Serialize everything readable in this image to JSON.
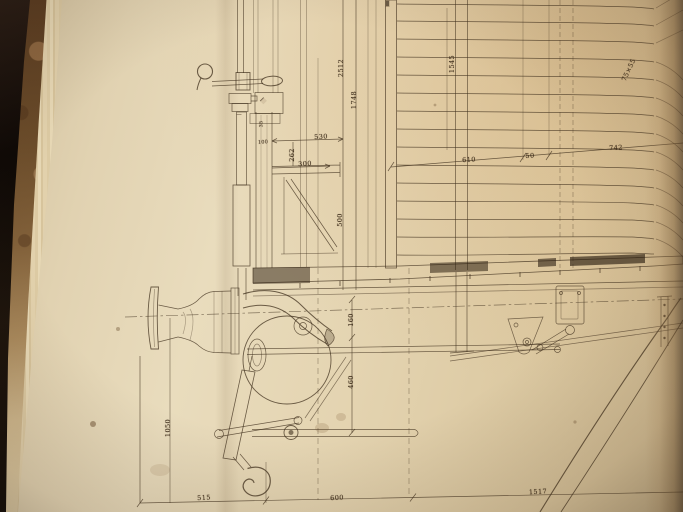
{
  "photo": {
    "subject": "engineering-drawing-in-bound-book",
    "colors": {
      "paper_light": "#e9dcbd",
      "paper_dark": "#d3bd93",
      "ink": "#40301e",
      "book_cover": "#0d0805",
      "marbled_edge": "#6b4c2a",
      "page_curl_shadow": "#4a3721"
    }
  },
  "drawing": {
    "dimensions": {
      "d2512": "2512",
      "d1748": "1748",
      "d530": "530",
      "d262": "262",
      "d300": "300",
      "d1545": "1545",
      "d75x55": "75×55",
      "d610": "610",
      "d50": "50",
      "d742": "742",
      "d500": "500",
      "d160": "160",
      "d460": "460",
      "d1050": "1050",
      "d515": "515",
      "d600": "600",
      "d1517": "1517",
      "d35": "35",
      "d100": "100"
    }
  }
}
